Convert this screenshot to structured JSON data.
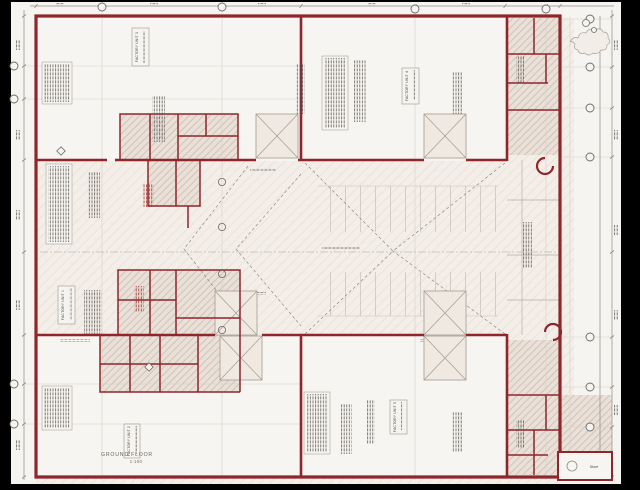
{
  "drawing": {
    "title": {
      "floor_label": "GROUND FLOOR",
      "scale_label": "1:100"
    },
    "units": [
      {
        "label": "FACTORY UNIT 1"
      },
      {
        "label": "FACTORY UNIT 2"
      },
      {
        "label": "FACTORY UNIT 3"
      },
      {
        "label": "FACTORY UNIT 4"
      },
      {
        "label": "FACTORY UNIT 5"
      }
    ],
    "rooms": {
      "store_label": "Store"
    },
    "colors": {
      "frame": "#000000",
      "sheet": "#f6f4f0",
      "wall": "#8e262c",
      "room_hatch": "#e9e0d8",
      "yard_hatch": "#f4efe9",
      "line": "#8f8b86",
      "red_note": "#a0342f"
    }
  }
}
